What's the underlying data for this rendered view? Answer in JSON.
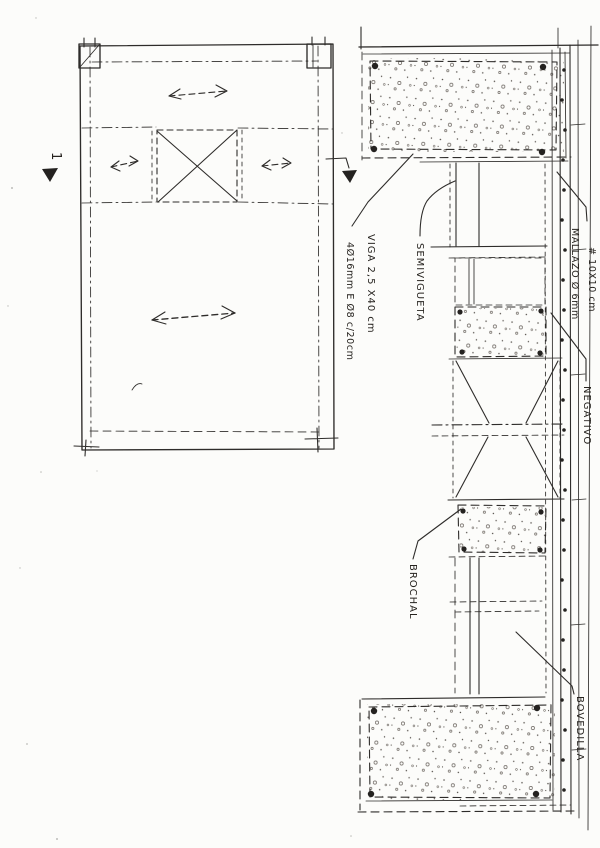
{
  "drawing": {
    "labels": {
      "viga": {
        "line1": "VIGA 2,5 X40 cm",
        "line2": "4Ø16mm E Ø8 c/20cm"
      },
      "semivigueta": "SEMIVIGUETA",
      "mallazo": {
        "line1": "MALLAZO Ø 6mm",
        "line2": "# 10X10 cm"
      },
      "negativo": "NEGATIVO",
      "brochal": "BROCHAL",
      "bovedilla": "BOVEDILLA",
      "section_mark": "1"
    },
    "colors": {
      "ink": "#2e2c2a",
      "paper": "#fcfcfa"
    }
  }
}
